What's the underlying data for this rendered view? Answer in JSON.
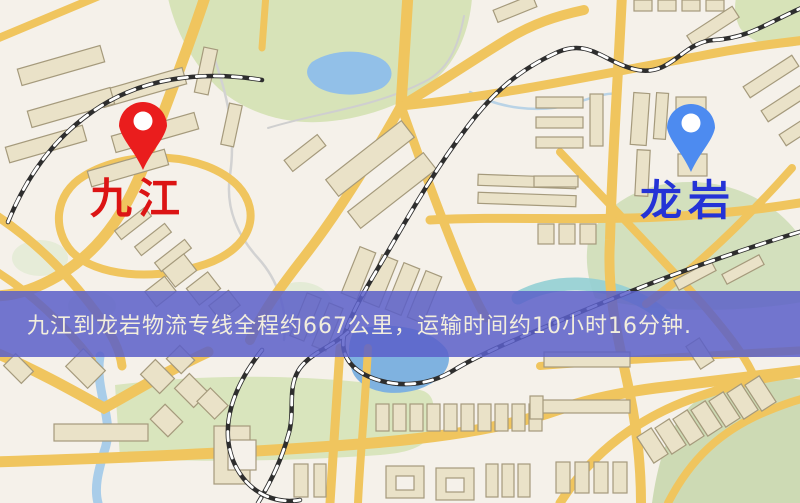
{
  "banner": {
    "text": "九江到龙岩物流专线全程约667公里，运输时间约10小时16分钟.",
    "background_color": "#5b5fc9",
    "text_color": "#f2eedd"
  },
  "markers": {
    "origin": {
      "label": "九江",
      "pin_color": "#ea1d1d",
      "label_color": "#dc1414"
    },
    "destination": {
      "label": "龙岩",
      "pin_color": "#4d8bf0",
      "label_color": "#2433d6"
    }
  },
  "map_palette": {
    "background": "#f5f1ea",
    "road": "#f0c55e",
    "building_fill": "#eae2c8",
    "building_outline": "#a59a7c",
    "park_green": "#d7e3b8",
    "hill_green": "#d3e0bd",
    "water_blue": "#92c0e8",
    "river_teal": "#93cfd4",
    "railway_dark": "#2e2e2e"
  }
}
